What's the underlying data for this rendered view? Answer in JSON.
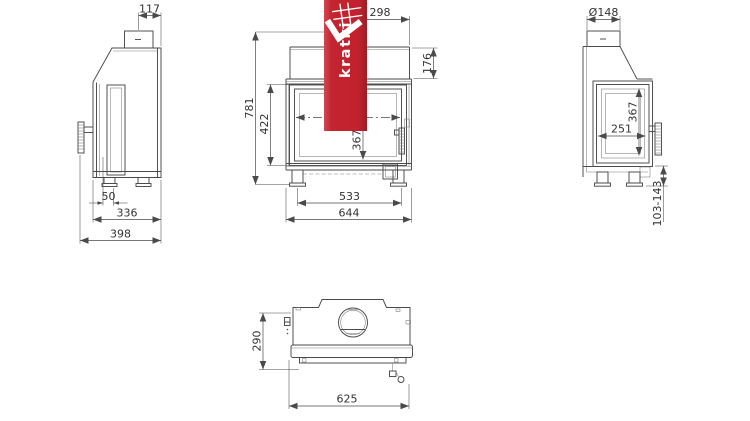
{
  "brand": {
    "name": "kratki"
  },
  "dimensions": {
    "left_view": {
      "flue_center_from_rear": "117",
      "front_offset": "50",
      "body_depth": "336",
      "total_depth": "398"
    },
    "front_view": {
      "flue_center_from_right": "298",
      "hood_height": "176",
      "total_height": "781",
      "door_height": "422",
      "glass_height": "367",
      "glass_width": "533",
      "total_width": "644"
    },
    "right_view": {
      "flue_diameter": "Ø148",
      "side_glass_height": "367",
      "side_glass_width": "251",
      "legs_height_range": "103-143"
    },
    "top_view": {
      "body_depth": "290",
      "front_width": "625"
    }
  }
}
